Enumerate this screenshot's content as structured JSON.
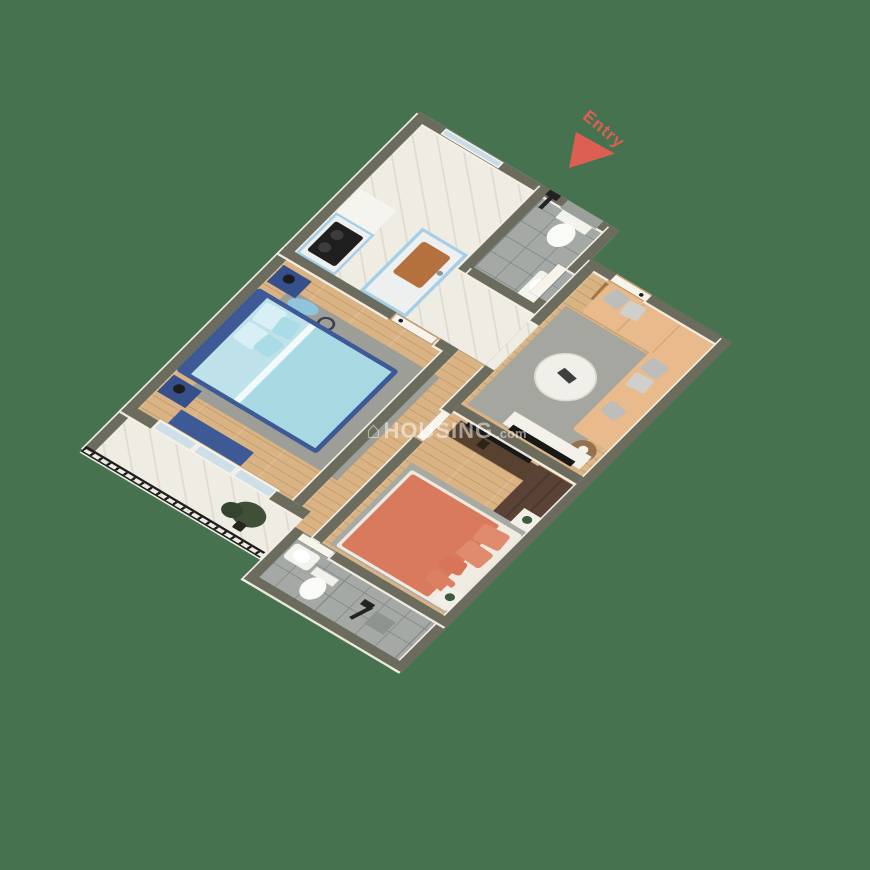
{
  "labels": {
    "entry": "Entry"
  },
  "watermark": {
    "icon": "⌂",
    "brand": "HOUSING",
    "suffix": ".com",
    "color": "rgba(255,255,255,0.5)"
  },
  "palette": {
    "background_green": "#47724f",
    "wall_top_olive": "#6c6c5e",
    "wall_face_cream": "#f4efe5",
    "entry_red": "#dd5f52",
    "kitchen_cabinet_blue": "#a5cfe8",
    "master_bed_navy": "#3d5a96",
    "master_bedding_blue": "#a9d9e3",
    "sofa_tan": "#e9ba8b",
    "bed2_coral": "#d97a5e",
    "wardrobe_brown": "#5a4336",
    "wood_floor": "#d9b383",
    "marble_floor": "#efece3",
    "tile_floor": "#a4a9a5",
    "railing_black": "#1e1e1e"
  },
  "scene": {
    "plan": {
      "w": 460,
      "h": 640
    },
    "entry_pos": {
      "left": 585,
      "top": 104
    },
    "watermark_pos": {
      "left": 366,
      "top": 418
    },
    "rooms": [
      "kitchen",
      "bathroom-1",
      "entry-hall",
      "living-room",
      "master-bedroom",
      "corridor",
      "bedroom-2",
      "balcony",
      "bathroom-2"
    ],
    "floors": [
      {
        "n": "kitchen-hall-floor",
        "x": 0,
        "y": 0,
        "w": 270,
        "h": 240,
        "k": "floor-marble"
      },
      {
        "n": "bath1-floor",
        "x": 177,
        "y": 0,
        "w": 81,
        "h": 150,
        "k": "floor-tile"
      },
      {
        "n": "living-floor",
        "x": 282,
        "y": 62,
        "w": 166,
        "h": 238,
        "k": "floor-wood"
      },
      {
        "n": "corridor-floor",
        "x": 234,
        "y": 240,
        "w": 48,
        "h": 308,
        "k": "floor-wood"
      },
      {
        "n": "master-floor",
        "x": 12,
        "y": 252,
        "w": 210,
        "h": 268,
        "k": "floor-wood"
      },
      {
        "n": "bedroom2-floor",
        "x": 282,
        "y": 300,
        "w": 166,
        "h": 248,
        "k": "floor-wood"
      },
      {
        "n": "balcony-floor",
        "x": 0,
        "y": 520,
        "w": 246,
        "h": 88,
        "k": "floor-marble"
      },
      {
        "n": "bath2-floor",
        "x": 252,
        "y": 548,
        "w": 196,
        "h": 92,
        "k": "floor-tile"
      },
      {
        "n": "hall-living-opening-floor",
        "x": 270,
        "y": 160,
        "w": 12,
        "h": 80,
        "k": "floor-marble"
      },
      {
        "n": "master-door-floor",
        "x": 150,
        "y": 240,
        "w": 60,
        "h": 12,
        "k": "floor-wood"
      },
      {
        "n": "entry-opening-floor",
        "x": 304,
        "y": 50,
        "w": 48,
        "h": 12,
        "k": "floor-wood"
      },
      {
        "n": "bath1-door-floor",
        "x": 258,
        "y": 78,
        "w": 12,
        "h": 50,
        "k": "floor-tile"
      },
      {
        "n": "bedroom2-door-floor",
        "x": 270,
        "y": 318,
        "w": 12,
        "h": 50,
        "k": "floor-wood"
      },
      {
        "n": "bath2-door-floor",
        "x": 252,
        "y": 548,
        "w": 50,
        "h": 12,
        "k": "floor-tile"
      }
    ],
    "walls": [
      {
        "n": "kitchen-ne-wall",
        "x": 0,
        "y": 0,
        "w": 270,
        "h": 12
      },
      {
        "n": "bath1-east-wall-a",
        "x": 258,
        "y": 0,
        "w": 12,
        "h": 78
      },
      {
        "n": "bath1-east-wall-b",
        "x": 258,
        "y": 128,
        "w": 12,
        "h": 22
      },
      {
        "n": "entry-wall-a",
        "x": 270,
        "y": 50,
        "w": 34,
        "h": 12
      },
      {
        "n": "entry-wall-b",
        "x": 352,
        "y": 50,
        "w": 108,
        "h": 12
      },
      {
        "n": "east-wall",
        "x": 448,
        "y": 50,
        "w": 12,
        "h": 590
      },
      {
        "n": "west-wall",
        "x": 0,
        "y": 0,
        "w": 12,
        "h": 600
      },
      {
        "n": "kitchen-bath1-divider-wall",
        "x": 165,
        "y": 0,
        "w": 12,
        "h": 150
      },
      {
        "n": "bath1-south-wall",
        "x": 177,
        "y": 138,
        "w": 93,
        "h": 12
      },
      {
        "n": "kitchen-south-wall-a",
        "x": 0,
        "y": 240,
        "w": 150,
        "h": 12
      },
      {
        "n": "kitchen-south-wall-b",
        "x": 210,
        "y": 240,
        "w": 24,
        "h": 12
      },
      {
        "n": "living-west-wall-a",
        "x": 270,
        "y": 62,
        "w": 12,
        "h": 98
      },
      {
        "n": "living-west-wall-b",
        "x": 270,
        "y": 240,
        "w": 12,
        "h": 72
      },
      {
        "n": "living-bedroom2-wall",
        "x": 282,
        "y": 300,
        "w": 166,
        "h": 12
      },
      {
        "n": "bedroom2-west-wall-a",
        "x": 270,
        "y": 300,
        "w": 12,
        "h": 18
      },
      {
        "n": "bedroom2-west-wall-b",
        "x": 270,
        "y": 368,
        "w": 12,
        "h": 180
      },
      {
        "n": "master-east-wall",
        "x": 222,
        "y": 252,
        "w": 12,
        "h": 268
      },
      {
        "n": "master-south-wall-a",
        "x": 0,
        "y": 520,
        "w": 40,
        "h": 14
      },
      {
        "n": "master-south-wall-b",
        "x": 200,
        "y": 520,
        "w": 46,
        "h": 14
      },
      {
        "n": "bath2-north-wall-a",
        "x": 246,
        "y": 548,
        "w": 8,
        "h": 12
      },
      {
        "n": "bath2-north-wall-b",
        "x": 302,
        "y": 548,
        "w": 158,
        "h": 12
      },
      {
        "n": "bath2-west-wall",
        "x": 246,
        "y": 548,
        "w": 12,
        "h": 92
      },
      {
        "n": "bath2-south-wall",
        "x": 246,
        "y": 628,
        "w": 214,
        "h": 12
      }
    ],
    "railing": {
      "n": "balcony-railing",
      "x": 0,
      "y": 596,
      "w": 242,
      "h": 10
    },
    "items": [
      {
        "n": "range-hood",
        "x": 14,
        "y": 126,
        "w": 50,
        "h": 44,
        "f": "#f5f4ef"
      },
      {
        "n": "stove-counter",
        "x": 14,
        "y": 168,
        "w": 52,
        "h": 72,
        "f": "#a5cfe8"
      },
      {
        "n": "stove-countertop",
        "x": 17,
        "y": 171,
        "w": 46,
        "h": 66,
        "f": "#eef0ef"
      },
      {
        "n": "gas-stove",
        "x": 21,
        "y": 178,
        "w": 38,
        "h": 52,
        "f": "#1f1f1f",
        "br": "3px"
      },
      {
        "n": "stove-burner-1",
        "x": 27,
        "y": 186,
        "w": 14,
        "h": 14,
        "f": "#3c3c3c",
        "br": "50%"
      },
      {
        "n": "stove-burner-2",
        "x": 27,
        "y": 208,
        "w": 14,
        "h": 14,
        "f": "#3c3c3c",
        "br": "50%"
      },
      {
        "n": "kitchen-island",
        "x": 100,
        "y": 128,
        "w": 62,
        "h": 112,
        "f": "#a5cfe8"
      },
      {
        "n": "kitchen-island-top",
        "x": 104,
        "y": 132,
        "w": 54,
        "h": 104,
        "f": "#eef0ef"
      },
      {
        "n": "kitchen-sink",
        "x": 112,
        "y": 142,
        "w": 38,
        "h": 56,
        "f": "#b4713e",
        "br": "4px"
      },
      {
        "n": "kitchen-faucet",
        "x": 150,
        "y": 164,
        "w": 7,
        "h": 7,
        "f": "#8d9396",
        "br": "50%"
      },
      {
        "n": "kitchen-window",
        "x": 36,
        "y": 1,
        "w": 78,
        "h": 10,
        "f": "#c8dbe6",
        "bd": "2px solid #f2f1ea",
        "z": 6
      },
      {
        "n": "bath1-tile-panel",
        "x": 200,
        "y": 0,
        "w": 48,
        "h": 14,
        "f": "#9aa09c",
        "z": 6
      },
      {
        "n": "shower1-pipe",
        "x": 181,
        "y": 2,
        "w": 5,
        "h": 26,
        "f": "#222222",
        "z": 6
      },
      {
        "n": "shower1-head",
        "x": 176,
        "y": 0,
        "w": 15,
        "h": 9,
        "f": "#222222",
        "z": 6
      },
      {
        "n": "toilet1-tank",
        "x": 204,
        "y": 12,
        "w": 40,
        "h": 16,
        "f": "#f3f3ee"
      },
      {
        "n": "toilet1-bowl",
        "x": 210,
        "y": 26,
        "w": 28,
        "h": 36,
        "f": "#fafaf7",
        "br": "50%"
      },
      {
        "n": "bath1-basin",
        "x": 236,
        "y": 96,
        "w": 22,
        "h": 46,
        "f": "#f3f3ee",
        "br": "4px"
      },
      {
        "n": "bath1-basin-bowl",
        "x": 239,
        "y": 106,
        "w": 16,
        "h": 20,
        "f": "#ffffff",
        "br": "50%"
      },
      {
        "n": "bath1-door",
        "x": 246,
        "y": 78,
        "w": 12,
        "h": 50,
        "k": "leaf"
      },
      {
        "n": "entry-door",
        "x": 304,
        "y": 52,
        "w": 48,
        "h": 10,
        "k": "leaf"
      },
      {
        "n": "entry-door-handle",
        "x": 340,
        "y": 55,
        "w": 5,
        "h": 5,
        "f": "#1b1b1b",
        "br": "50%",
        "z": 7
      },
      {
        "n": "doormat",
        "x": 302,
        "y": 66,
        "w": 46,
        "h": 28,
        "f": "#b98e5c",
        "bd": "3px solid #9d7647",
        "r": -3
      },
      {
        "n": "living-rug",
        "x": 288,
        "y": 120,
        "w": 132,
        "h": 176,
        "f": "#a6a6a0"
      },
      {
        "n": "sofa-main",
        "x": 306,
        "y": 64,
        "w": 146,
        "h": 52,
        "f": "#e9ba8b",
        "br": "4px"
      },
      {
        "n": "sofa-chaise",
        "x": 398,
        "y": 114,
        "w": 54,
        "h": 140,
        "f": "#e9ba8b",
        "br": "4px"
      },
      {
        "n": "sofa-seam-1",
        "x": 352,
        "y": 66,
        "w": 2,
        "h": 48,
        "f": "#d8a878"
      },
      {
        "n": "sofa-seam-2",
        "x": 400,
        "y": 66,
        "w": 2,
        "h": 48,
        "f": "#d8a878"
      },
      {
        "n": "sofa-pillow-1",
        "x": 314,
        "y": 68,
        "w": 22,
        "h": 22,
        "f": "#bdbdbb",
        "r": 8,
        "br": "3px"
      },
      {
        "n": "sofa-pillow-2",
        "x": 338,
        "y": 70,
        "w": 22,
        "h": 22,
        "f": "#cfcfcc",
        "r": -7,
        "br": "3px"
      },
      {
        "n": "sofa-pillow-3",
        "x": 404,
        "y": 120,
        "w": 24,
        "h": 22,
        "f": "#bdbdbb",
        "r": 6,
        "br": "3px"
      },
      {
        "n": "sofa-pillow-4",
        "x": 404,
        "y": 146,
        "w": 24,
        "h": 22,
        "f": "#cfcfcc",
        "r": -5,
        "br": "3px"
      },
      {
        "n": "sofa-pillow-5",
        "x": 406,
        "y": 196,
        "w": 22,
        "h": 20,
        "f": "#bdbdbb",
        "r": 10,
        "br": "3px"
      },
      {
        "n": "coffee-table",
        "x": 314,
        "y": 166,
        "w": 68,
        "h": 68,
        "f": "#f1efea",
        "br": "50%",
        "bd": "2px solid #dcd8d0"
      },
      {
        "n": "coffee-table-decor",
        "x": 338,
        "y": 192,
        "w": 20,
        "h": 11,
        "f": "#3f3f3f",
        "r": 12
      },
      {
        "n": "side-table",
        "x": 410,
        "y": 256,
        "w": 30,
        "h": 30,
        "f": "#96714d",
        "br": "50%"
      },
      {
        "n": "side-table-decor",
        "x": 419,
        "y": 264,
        "w": 11,
        "h": 11,
        "f": "#f4f2ec",
        "br": "50%"
      },
      {
        "n": "tv-cabinet",
        "x": 334,
        "y": 272,
        "w": 104,
        "h": 22,
        "f": "#f3f1ea"
      },
      {
        "n": "living-tv",
        "x": 344,
        "y": 288,
        "w": 84,
        "h": 9,
        "f": "#181818"
      },
      {
        "n": "bedroom2-tv-console",
        "x": 296,
        "y": 318,
        "w": 118,
        "h": 26,
        "f": "#57422f"
      },
      {
        "n": "bedroom2-tv",
        "x": 304,
        "y": 313,
        "w": 86,
        "h": 8,
        "f": "#181818"
      },
      {
        "n": "console-decor",
        "x": 330,
        "y": 324,
        "w": 10,
        "h": 12,
        "f": "#2e2317"
      },
      {
        "n": "wardrobe",
        "x": 400,
        "y": 316,
        "w": 48,
        "h": 88,
        "f": "#5a4336"
      },
      {
        "n": "wardrobe-seam-1",
        "x": 415,
        "y": 318,
        "w": 2,
        "h": 84,
        "f": "#49372b"
      },
      {
        "n": "wardrobe-seam-2",
        "x": 431,
        "y": 318,
        "w": 2,
        "h": 84,
        "f": "#49372b"
      },
      {
        "n": "bedroom2-rug",
        "x": 290,
        "y": 398,
        "w": 160,
        "h": 146,
        "f": "#a9a9a3"
      },
      {
        "n": "bed2-frame",
        "x": 296,
        "y": 406,
        "w": 150,
        "h": 136,
        "f": "#efebe0",
        "br": "3px"
      },
      {
        "n": "bed2-duvet",
        "x": 300,
        "y": 410,
        "w": 118,
        "h": 128,
        "f": "#d97a5e",
        "br": "3px"
      },
      {
        "n": "bed2-pillow-1",
        "x": 404,
        "y": 416,
        "w": 34,
        "h": 26,
        "f": "#e08a6e",
        "r": -5,
        "br": "4px"
      },
      {
        "n": "bed2-pillow-2",
        "x": 404,
        "y": 446,
        "w": 34,
        "h": 26,
        "f": "#e08a6e",
        "r": 4,
        "br": "4px"
      },
      {
        "n": "bed2-pillow-3",
        "x": 398,
        "y": 476,
        "w": 28,
        "h": 20,
        "f": "#d87457",
        "r": -9,
        "br": "4px"
      },
      {
        "n": "bed2-pillow-4",
        "x": 400,
        "y": 502,
        "w": 30,
        "h": 20,
        "f": "#dd8062",
        "r": 7,
        "br": "4px"
      },
      {
        "n": "bed2-nightstand-1",
        "x": 424,
        "y": 374,
        "w": 26,
        "h": 26,
        "f": "#f2efe8"
      },
      {
        "n": "bed2-nightstand-plant-1",
        "x": 431,
        "y": 380,
        "w": 11,
        "h": 11,
        "f": "#3c5a3c",
        "br": "50%"
      },
      {
        "n": "bed2-nightstand-2",
        "x": 424,
        "y": 512,
        "w": 26,
        "h": 26,
        "f": "#f2efe8"
      },
      {
        "n": "bed2-nightstand-plant-2",
        "x": 431,
        "y": 518,
        "w": 11,
        "h": 11,
        "f": "#3c5a3c",
        "br": "50%"
      },
      {
        "n": "bedroom2-door",
        "x": 272,
        "y": 318,
        "w": 10,
        "h": 48,
        "k": "leaf"
      },
      {
        "n": "master-rug",
        "x": 40,
        "y": 284,
        "w": 202,
        "h": 184,
        "f": "#9e9e98"
      },
      {
        "n": "wall-decor-disc",
        "x": 48,
        "y": 286,
        "w": 36,
        "h": 20,
        "f": "#8fc4dc",
        "br": "50%",
        "r": -12
      },
      {
        "n": "wall-decor-ring",
        "x": 90,
        "y": 290,
        "w": 20,
        "h": 20,
        "f": "transparent",
        "bd": "3px solid #39404f",
        "br": "50%"
      },
      {
        "n": "bed1-frame",
        "x": 12,
        "y": 304,
        "w": 190,
        "h": 148,
        "f": "#3d5a96",
        "br": "4px"
      },
      {
        "n": "bed1-mattress",
        "x": 28,
        "y": 310,
        "w": 168,
        "h": 136,
        "f": "#bfe2ea"
      },
      {
        "n": "bed1-duvet",
        "x": 86,
        "y": 310,
        "w": 110,
        "h": 136,
        "f": "#a9d9e3"
      },
      {
        "n": "bed1-fold",
        "x": 86,
        "y": 310,
        "w": 8,
        "h": 136,
        "f": "#f2fafc"
      },
      {
        "n": "bed1-pillow-1",
        "x": 32,
        "y": 314,
        "w": 28,
        "h": 30,
        "f": "#d8f0f5",
        "r": -3,
        "br": "4px"
      },
      {
        "n": "bed1-pillow-2",
        "x": 32,
        "y": 348,
        "w": 28,
        "h": 30,
        "f": "#d8f0f5",
        "r": 3,
        "br": "4px"
      },
      {
        "n": "bed1-pillow-3",
        "x": 58,
        "y": 318,
        "w": 24,
        "h": 26,
        "f": "#a9dce6",
        "r": -7,
        "br": "4px"
      },
      {
        "n": "bed1-pillow-4",
        "x": 58,
        "y": 350,
        "w": 24,
        "h": 26,
        "f": "#a9dce6",
        "r": 6,
        "br": "4px"
      },
      {
        "n": "nightstand-1",
        "x": 14,
        "y": 262,
        "w": 38,
        "h": 30,
        "f": "#35508a"
      },
      {
        "n": "nightstand-lamp-1",
        "x": 24,
        "y": 268,
        "w": 13,
        "h": 13,
        "f": "#1d1d1d",
        "br": "50%"
      },
      {
        "n": "nightstand-2",
        "x": 14,
        "y": 458,
        "w": 38,
        "h": 30,
        "f": "#35508a"
      },
      {
        "n": "nightstand-lamp-2",
        "x": 24,
        "y": 464,
        "w": 13,
        "h": 13,
        "f": "#1d1d1d",
        "br": "50%"
      },
      {
        "n": "bench",
        "x": 50,
        "y": 492,
        "w": 98,
        "h": 24,
        "f": "#3d5a96"
      },
      {
        "n": "master-door",
        "x": 152,
        "y": 242,
        "w": 54,
        "h": 10,
        "k": "leaf"
      },
      {
        "n": "master-door-handle",
        "x": 158,
        "y": 244,
        "w": 5,
        "h": 5,
        "f": "#1b1b1b",
        "br": "50%",
        "z": 7
      },
      {
        "n": "balcony-slider-1",
        "x": 40,
        "y": 517,
        "w": 54,
        "h": 17,
        "k": "glass"
      },
      {
        "n": "balcony-slider-2",
        "x": 94,
        "y": 517,
        "w": 54,
        "h": 17,
        "k": "glass"
      },
      {
        "n": "balcony-slider-3",
        "x": 148,
        "y": 517,
        "w": 54,
        "h": 17,
        "k": "glass"
      },
      {
        "n": "balcony-plant",
        "x": 176,
        "y": 548,
        "w": 40,
        "h": 34,
        "f": "#3f4f38",
        "br": "50%"
      },
      {
        "n": "balcony-plant-leaves",
        "x": 166,
        "y": 560,
        "w": 24,
        "h": 22,
        "f": "#34432e",
        "br": "50%"
      },
      {
        "n": "balcony-plant-pot",
        "x": 192,
        "y": 578,
        "w": 12,
        "h": 12,
        "f": "#26261f",
        "br": "2px"
      },
      {
        "n": "bath2-basin",
        "x": 260,
        "y": 564,
        "w": 34,
        "h": 26,
        "f": "#f3f3ee",
        "br": "5px"
      },
      {
        "n": "bath2-basin-bowl",
        "x": 266,
        "y": 568,
        "w": 20,
        "h": 17,
        "f": "#ffffff",
        "br": "50%"
      },
      {
        "n": "toilet2-tank",
        "x": 298,
        "y": 578,
        "w": 30,
        "h": 12,
        "f": "#f1f1ec"
      },
      {
        "n": "toilet2-bowl",
        "x": 300,
        "y": 588,
        "w": 26,
        "h": 34,
        "f": "#fafaf7",
        "br": "50%"
      },
      {
        "n": "shower2-tile-mat",
        "x": 386,
        "y": 588,
        "w": 26,
        "h": 22,
        "f": "#8f938f"
      },
      {
        "n": "shower2-pipe",
        "x": 372,
        "y": 586,
        "w": 5,
        "h": 28,
        "f": "#222222",
        "r": 18
      },
      {
        "n": "shower2-head",
        "x": 366,
        "y": 582,
        "w": 14,
        "h": 9,
        "f": "#222222"
      },
      {
        "n": "bath2-door",
        "x": 254,
        "y": 550,
        "w": 46,
        "h": 10,
        "k": "leaf"
      }
    ]
  }
}
